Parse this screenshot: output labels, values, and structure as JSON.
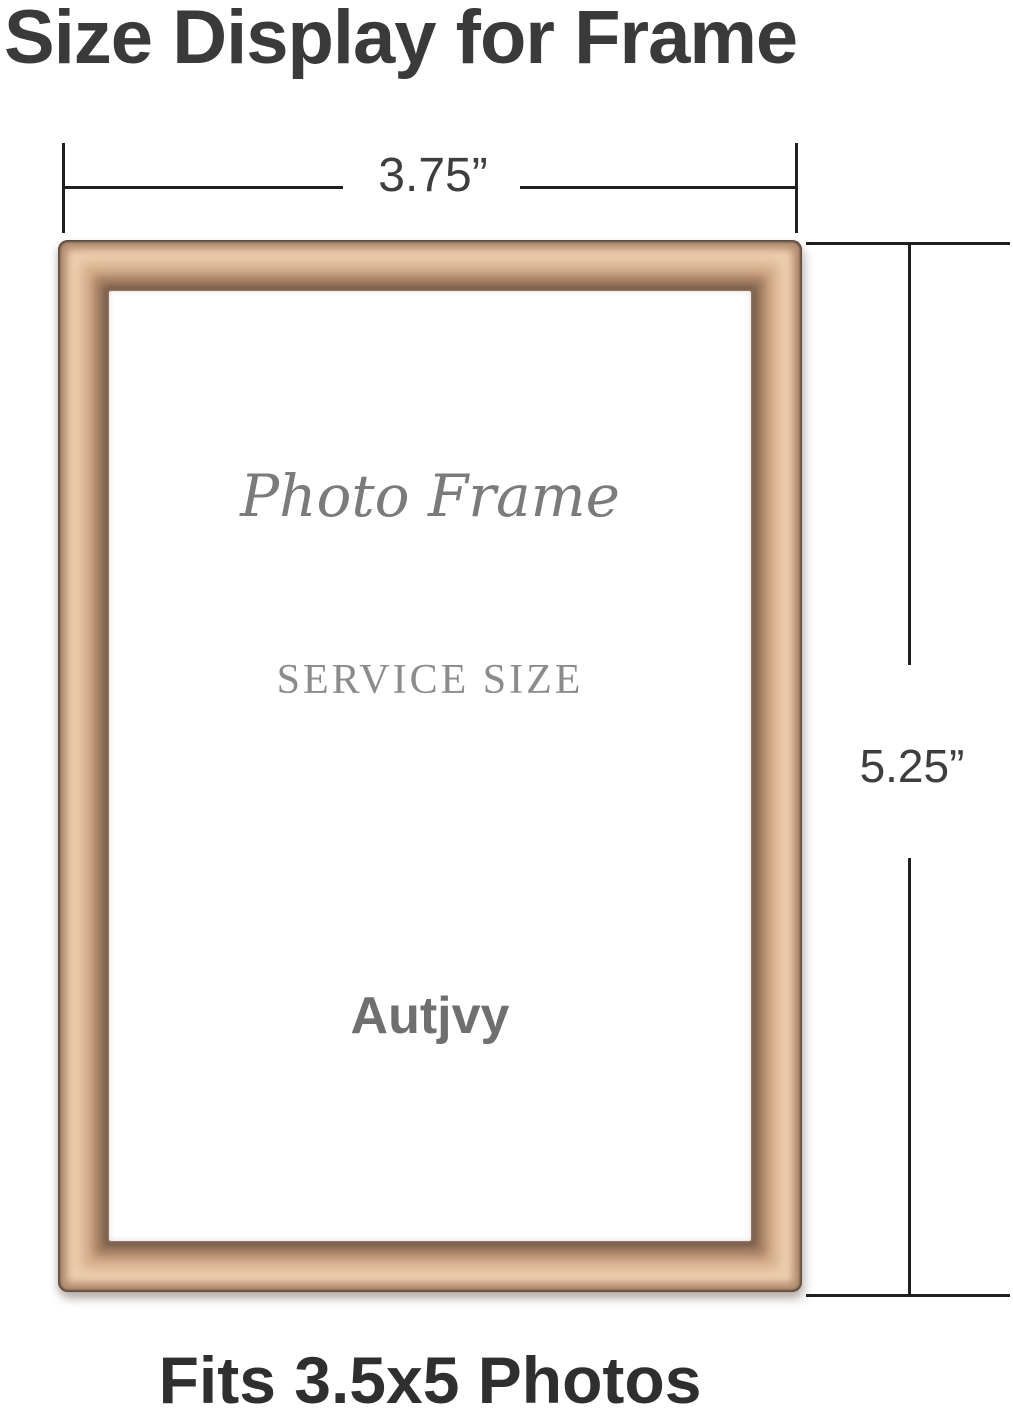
{
  "title": "Size Display for Frame",
  "dimensions": {
    "width_label": "3.75”",
    "height_label": "5.25”"
  },
  "frame": {
    "script_text": "Photo Frame",
    "size_text": "SERVICE SIZE",
    "brand_text": "Autjvy"
  },
  "footer": "Fits 3.5x5 Photos",
  "colors": {
    "text_dark": "#3a3a3a",
    "footer_dark": "#2f2f2f",
    "dim_line": "#1f1f1f",
    "dim_text": "#3e3e3e",
    "frame_outline": "#55473d",
    "frame_edge": "#b08a6c",
    "frame_gold_light": "#ecceae",
    "frame_gold_mid": "#d3ac88",
    "frame_gold_dark": "#9f7a5e",
    "frame_inner_line": "#6e5949",
    "interior_gray": "#7b7b7b",
    "serif_gray": "#8b8b8b",
    "brand_gray": "#6f6f6f"
  }
}
